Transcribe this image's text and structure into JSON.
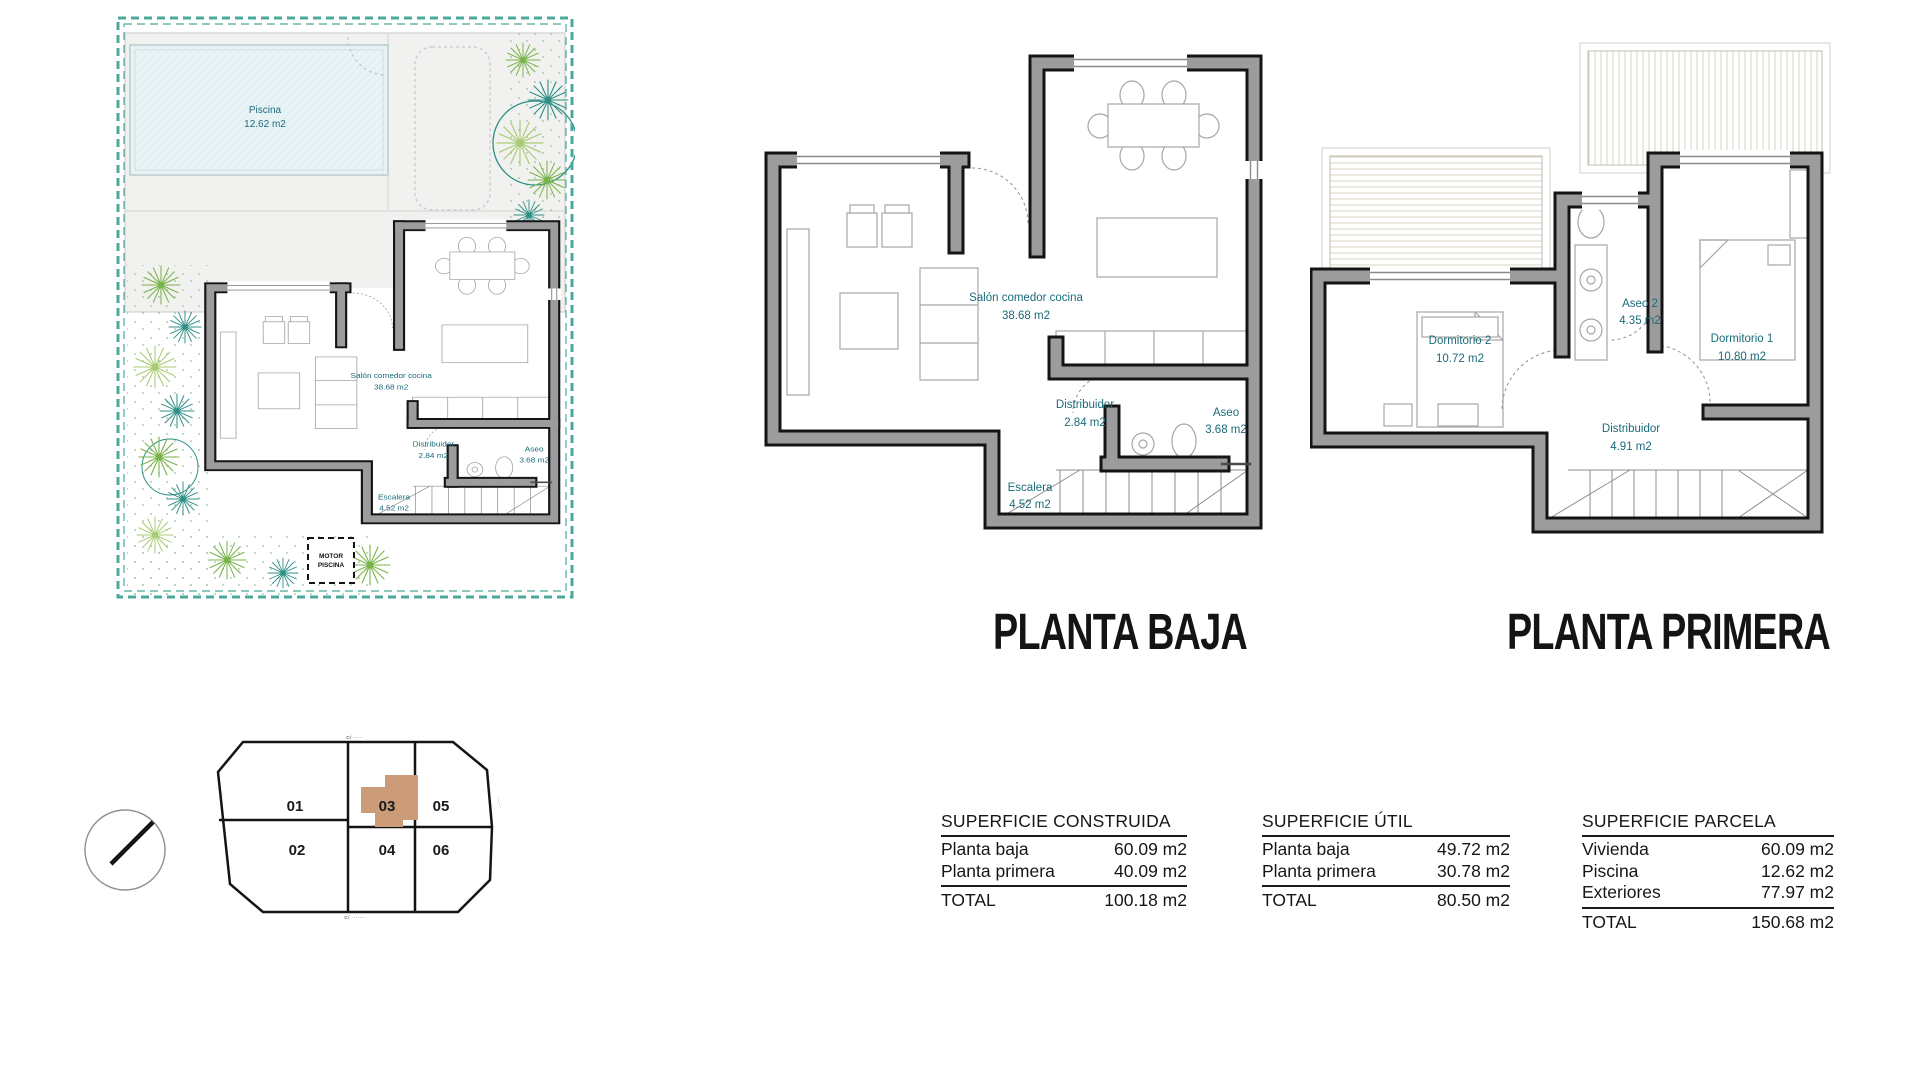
{
  "titles": {
    "planta_baja": "PLANTA BAJA",
    "planta_primera": "PLANTA PRIMERA"
  },
  "site_plan": {
    "piscina": {
      "name": "Piscina",
      "area": "12.62 m2"
    },
    "motor": {
      "line1": "MOTOR",
      "line2": "PISCINA"
    }
  },
  "planta_baja": {
    "rooms": {
      "salon": {
        "name": "Salón comedor cocina",
        "area": "38.68 m2"
      },
      "distribuidor": {
        "name": "Distribuidor",
        "area": "2.84 m2"
      },
      "aseo": {
        "name": "Aseo",
        "area": "3.68 m2"
      },
      "escalera": {
        "name": "Escalera",
        "area": "4.52 m2"
      }
    }
  },
  "planta_primera": {
    "rooms": {
      "dormitorio2": {
        "name": "Dormitorio 2",
        "area": "10.72 m2"
      },
      "aseo2": {
        "name": "Aseo 2",
        "area": "4.35 m2"
      },
      "dormitorio1": {
        "name": "Dormitorio 1",
        "area": "10.80 m2"
      },
      "distribuidor": {
        "name": "Distribuidor",
        "area": "4.91 m2"
      }
    }
  },
  "plot_map": {
    "plots": {
      "p01": "01",
      "p02": "02",
      "p03": "03",
      "p04": "04",
      "p05": "05",
      "p06": "06"
    },
    "street_top": "C/ ·····",
    "street_bottom": "C/ ·······",
    "street_left": "·····",
    "street_right": "·····"
  },
  "tables": {
    "construida": {
      "title": "SUPERFICIE CONSTRUIDA",
      "rows": [
        {
          "label": "Planta baja",
          "value": "60.09 m2"
        },
        {
          "label": "Planta primera",
          "value": "40.09 m2"
        }
      ],
      "total": {
        "label": "TOTAL",
        "value": "100.18 m2"
      }
    },
    "util": {
      "title": "SUPERFICIE ÚTIL",
      "rows": [
        {
          "label": "Planta baja",
          "value": "49.72 m2"
        },
        {
          "label": "Planta primera",
          "value": "30.78 m2"
        }
      ],
      "total": {
        "label": "TOTAL",
        "value": "80.50 m2"
      }
    },
    "parcela": {
      "title": "SUPERFICIE PARCELA",
      "rows": [
        {
          "label": "Vivienda",
          "value": "60.09 m2"
        },
        {
          "label": "Piscina",
          "value": "12.62 m2"
        },
        {
          "label": "Exteriores",
          "value": "77.97 m2"
        }
      ],
      "total": {
        "label": "TOTAL",
        "value": "150.68 m2"
      }
    }
  },
  "colors": {
    "label_teal": "#1a6b7a",
    "border_teal": "#4aa99b",
    "wall_gray": "#9c9c9c",
    "wall_line": "#141414",
    "highlight_tan": "#cb9c77",
    "pool_blue": "#e8f3f6"
  }
}
